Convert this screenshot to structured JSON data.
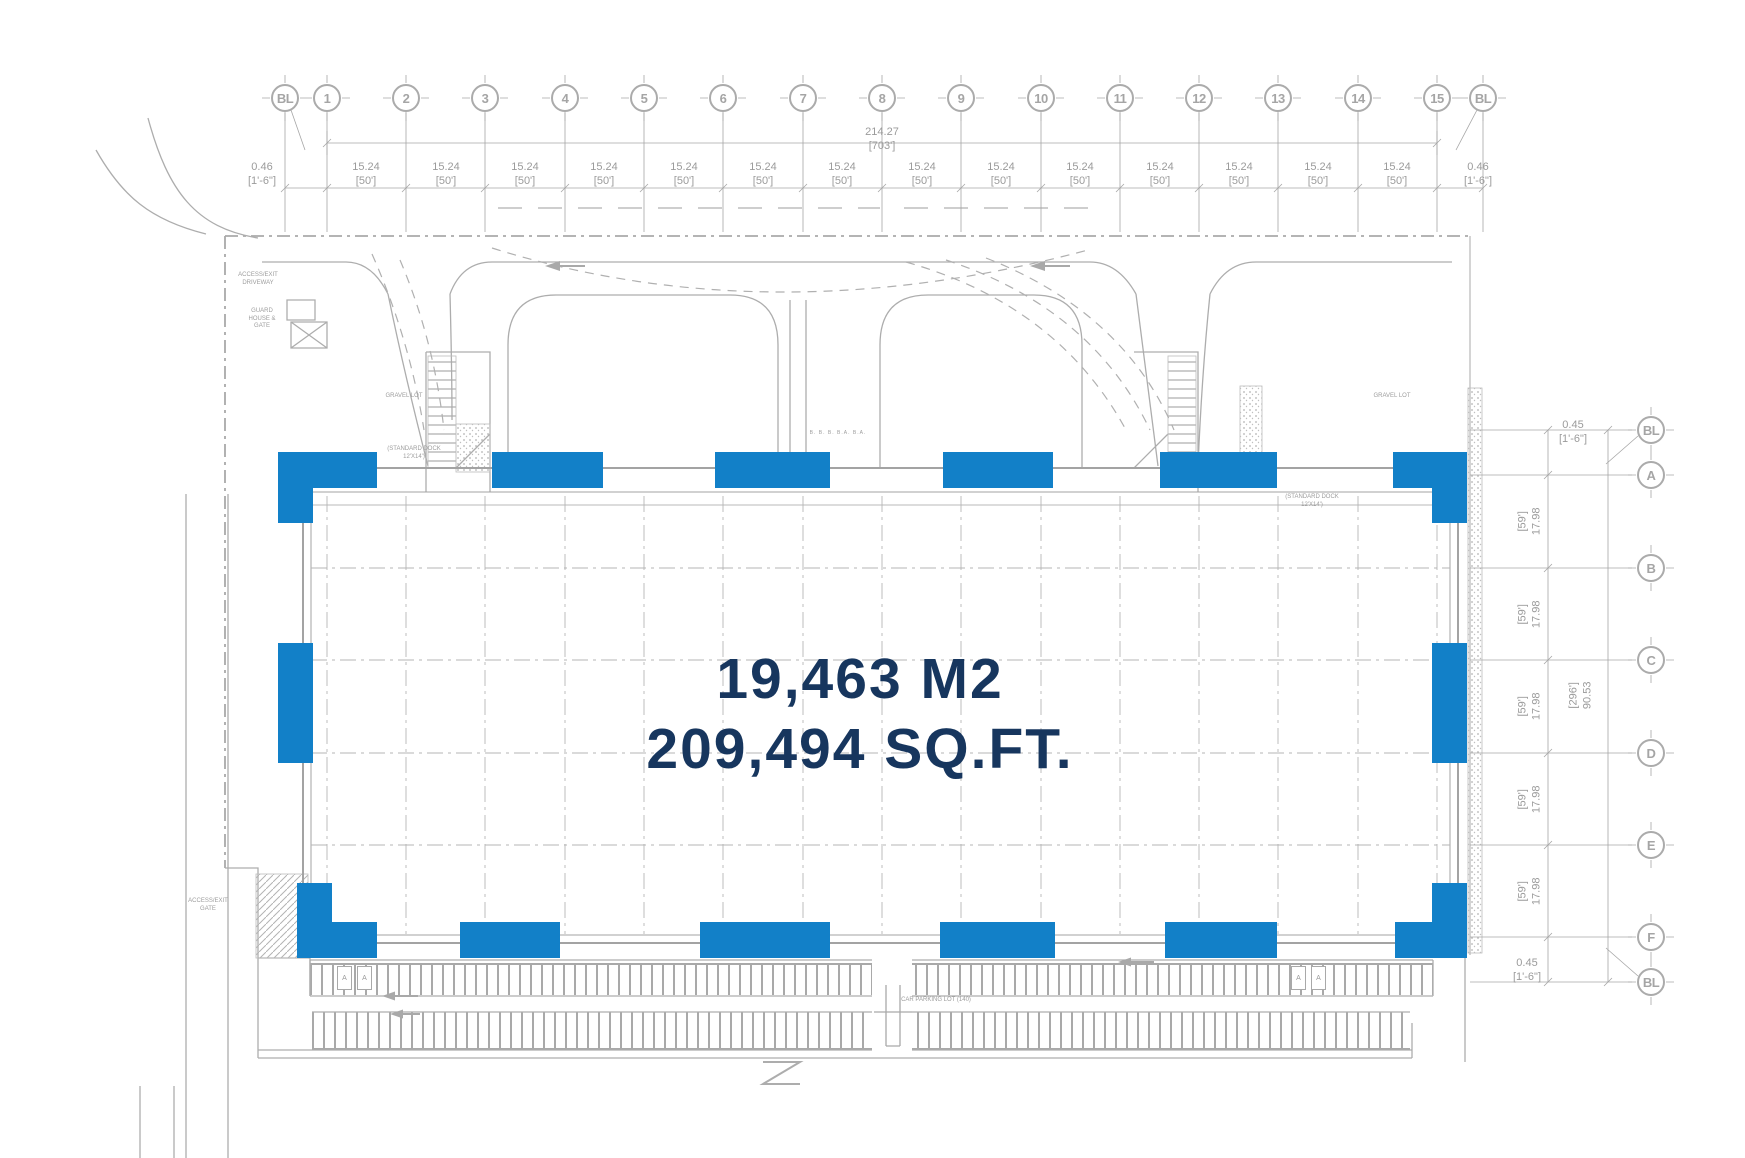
{
  "colors": {
    "highlight_blue": "#1280c8",
    "navy_text": "#17365e",
    "line_gray": "#a9a9a9",
    "text_gray": "#9b9b9b"
  },
  "building": {
    "area_m2": "19,463 M2",
    "area_sqft": "209,494 SQ.FT."
  },
  "grid_top": {
    "bubbles": [
      "BL",
      "1",
      "2",
      "3",
      "4",
      "5",
      "6",
      "7",
      "8",
      "9",
      "10",
      "11",
      "12",
      "13",
      "14",
      "15",
      "BL"
    ],
    "overall": {
      "metric": "214.27",
      "imperial": "[703']"
    },
    "dims": [
      {
        "metric": "0.46",
        "imperial": "[1'-6\"]"
      },
      {
        "metric": "15.24",
        "imperial": "[50']"
      },
      {
        "metric": "15.24",
        "imperial": "[50']"
      },
      {
        "metric": "15.24",
        "imperial": "[50']"
      },
      {
        "metric": "15.24",
        "imperial": "[50']"
      },
      {
        "metric": "15.24",
        "imperial": "[50']"
      },
      {
        "metric": "15.24",
        "imperial": "[50']"
      },
      {
        "metric": "15.24",
        "imperial": "[50']"
      },
      {
        "metric": "15.24",
        "imperial": "[50']"
      },
      {
        "metric": "15.24",
        "imperial": "[50']"
      },
      {
        "metric": "15.24",
        "imperial": "[50']"
      },
      {
        "metric": "15.24",
        "imperial": "[50']"
      },
      {
        "metric": "15.24",
        "imperial": "[50']"
      },
      {
        "metric": "15.24",
        "imperial": "[50']"
      },
      {
        "metric": "15.24",
        "imperial": "[50']"
      },
      {
        "metric": "0.46",
        "imperial": "[1'-6\"]"
      }
    ]
  },
  "grid_right": {
    "bubbles": [
      "BL",
      "A",
      "B",
      "C",
      "D",
      "E",
      "F",
      "BL"
    ],
    "overall": {
      "metric": "90.53",
      "imperial": "[296']"
    },
    "dim_top": {
      "metric": "0.45",
      "imperial": "[1'-6\"]"
    },
    "dim_bottom": {
      "metric": "0.45",
      "imperial": "[1'-6\"]"
    },
    "dims": [
      {
        "metric": "17.98",
        "imperial": "[59']"
      },
      {
        "metric": "17.98",
        "imperial": "[59']"
      },
      {
        "metric": "17.98",
        "imperial": "[59']"
      },
      {
        "metric": "17.98",
        "imperial": "[59']"
      },
      {
        "metric": "17.98",
        "imperial": "[59']"
      }
    ]
  },
  "site_labels": {
    "driveway": "ACCESS/EXIT\nDRIVEWAY",
    "guard_house": "GUARD\nHOUSE &\nGATE",
    "gravel_left": "GRAVEL LOT",
    "gravel_right": "GRAVEL LOT",
    "dock_left": "(STANDARD DOCK\n12'X14')",
    "dock_right": "(STANDARD DOCK\n12'X14')",
    "door_tags": "B. B. B. B.A. B.A.",
    "car_parking": "CAR PARKING LOT (140)",
    "gate": "ACCESS/EXIT\nGATE"
  },
  "dock_door_markers": [
    "A",
    "A",
    "A",
    "A"
  ]
}
